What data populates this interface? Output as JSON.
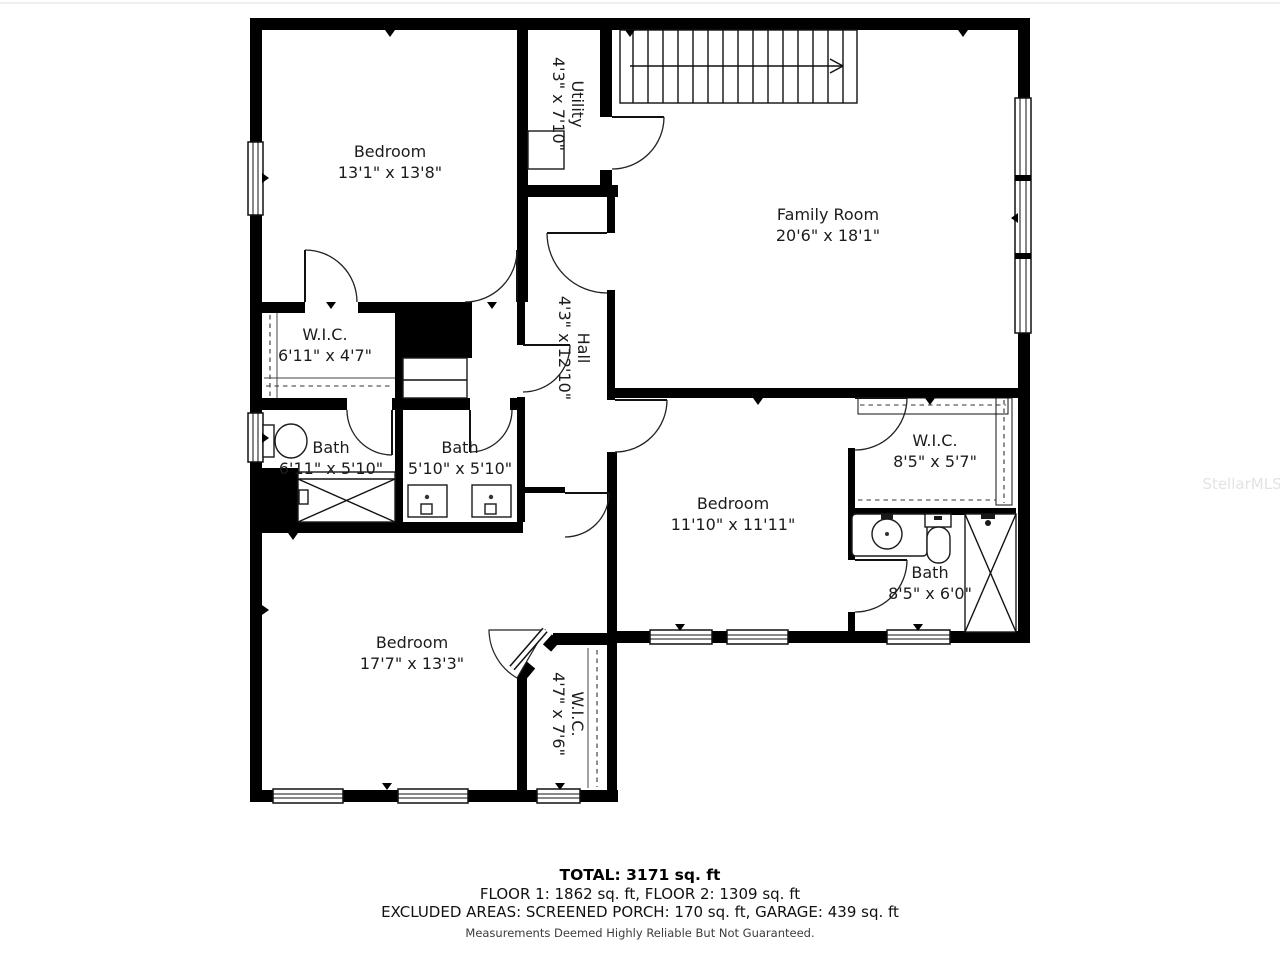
{
  "colors": {
    "wall": "#000000",
    "text": "#1c1c1c",
    "watermark": "#e3e3e3"
  },
  "watermark": {
    "text": "StellarMLS"
  },
  "rooms": [
    {
      "id": "bedroom-upper-left",
      "name": "Bedroom",
      "dims": "13'1\" x 13'8\""
    },
    {
      "id": "utility",
      "name": "Utility",
      "dims": "4'3\" x 7'10\""
    },
    {
      "id": "family-room",
      "name": "Family Room",
      "dims": "20'6\" x 18'1\""
    },
    {
      "id": "wic-left",
      "name": "W.I.C.",
      "dims": "6'11\" x 4'7\""
    },
    {
      "id": "hall",
      "name": "Hall",
      "dims": "4'3\" x 12'10\""
    },
    {
      "id": "bath-left",
      "name": "Bath",
      "dims": "6'11\" x 5'10\""
    },
    {
      "id": "bath-middle",
      "name": "Bath",
      "dims": "5'10\" x 5'10\""
    },
    {
      "id": "bedroom-middle",
      "name": "Bedroom",
      "dims": "11'10\" x 11'11\""
    },
    {
      "id": "wic-right",
      "name": "W.I.C.",
      "dims": "8'5\" x 5'7\""
    },
    {
      "id": "bath-right",
      "name": "Bath",
      "dims": "8'5\" x 6'0\""
    },
    {
      "id": "bedroom-lower-left",
      "name": "Bedroom",
      "dims": "17'7\" x 13'3\""
    },
    {
      "id": "wic-lower",
      "name": "W.I.C.",
      "dims": "4'7\" x 7'6\""
    }
  ],
  "summary": {
    "total": "TOTAL: 3171 sq. ft",
    "floors": "FLOOR 1: 1862 sq. ft, FLOOR 2: 1309 sq. ft",
    "excluded": "EXCLUDED AREAS: SCREENED PORCH: 170 sq. ft, GARAGE: 439 sq. ft",
    "disclaimer": "Measurements Deemed Highly Reliable But Not Guaranteed."
  }
}
